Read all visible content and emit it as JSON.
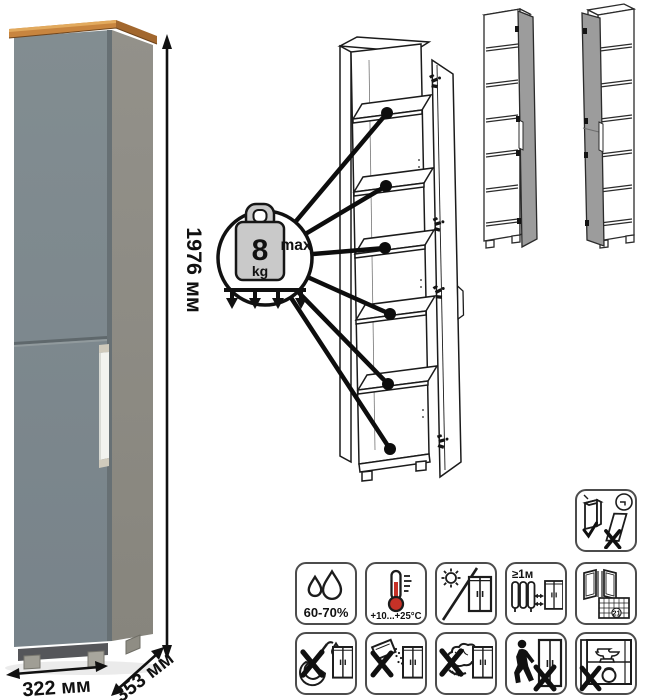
{
  "dimensions": {
    "height": "1976 мм",
    "width": "322 мм",
    "depth": "353 мм"
  },
  "shelf_load": {
    "value": "8",
    "unit": "kg",
    "max_label": "max"
  },
  "colors": {
    "door_front": "#7d888c",
    "side_panel": "#8e8c83",
    "wood_top": "#c8853f",
    "handle": "#f2f3ef",
    "line_art": "#1b1b1b",
    "icon_border": "#4c4c4c",
    "thermometer_red": "#c63127",
    "variant_door_gray": "#9c9c9c"
  },
  "icons": {
    "anti_tip": {
      "name": "secure-to-wall-warning"
    },
    "row1": [
      {
        "name": "humidity-range",
        "label": "60-70%"
      },
      {
        "name": "temperature-range",
        "label": "+10...+25°C"
      },
      {
        "name": "avoid-direct-sunlight"
      },
      {
        "name": "keep-1m-from-heat-sources",
        "label": "≥1м"
      },
      {
        "name": "ventilate-room",
        "calendar_day": "21"
      }
    ],
    "row2": [
      {
        "name": "no-water-spills"
      },
      {
        "name": "no-abrasive-powder"
      },
      {
        "name": "no-harsh-scrubbing"
      },
      {
        "name": "no-pushing-when-moving"
      },
      {
        "name": "no-heavy-objects"
      }
    ]
  }
}
